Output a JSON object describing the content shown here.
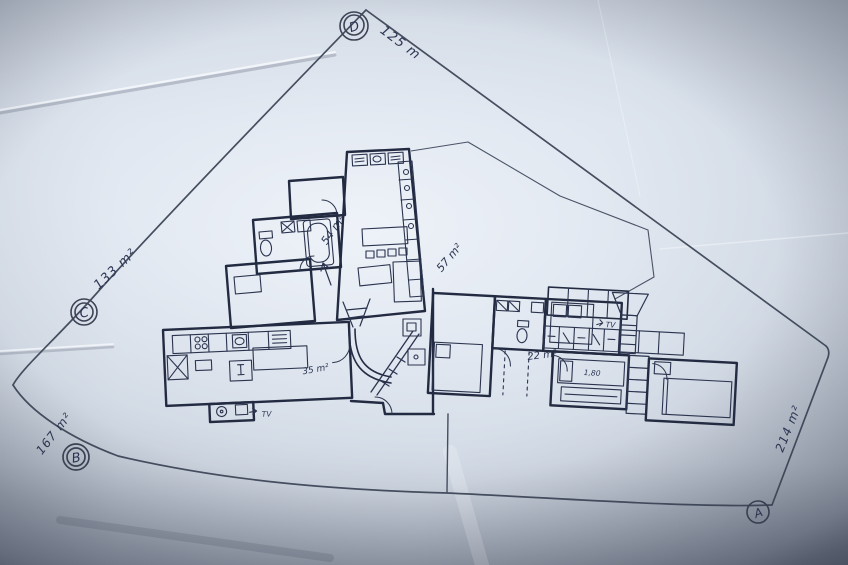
{
  "photo": {
    "parcels": {
      "marker_a": "A",
      "marker_b": "B",
      "marker_c": "C",
      "marker_d": "D",
      "measure_top_edge": "125 m",
      "measure_left_edge": "133 m²",
      "measure_bottom_left": "167 m²",
      "measure_right_edge": "214 m²"
    },
    "rooms": {
      "upper_living": "54 m²",
      "open_terrace": "57 m²",
      "central_hall": "35 m²",
      "right_wing": "22 m²",
      "bed_width": "1,80",
      "tv_left": "TV",
      "tv_right": "TV"
    },
    "colors": {
      "ink": "#27304a",
      "pencil": "#4a5468",
      "paper": "#dce3ed"
    }
  }
}
